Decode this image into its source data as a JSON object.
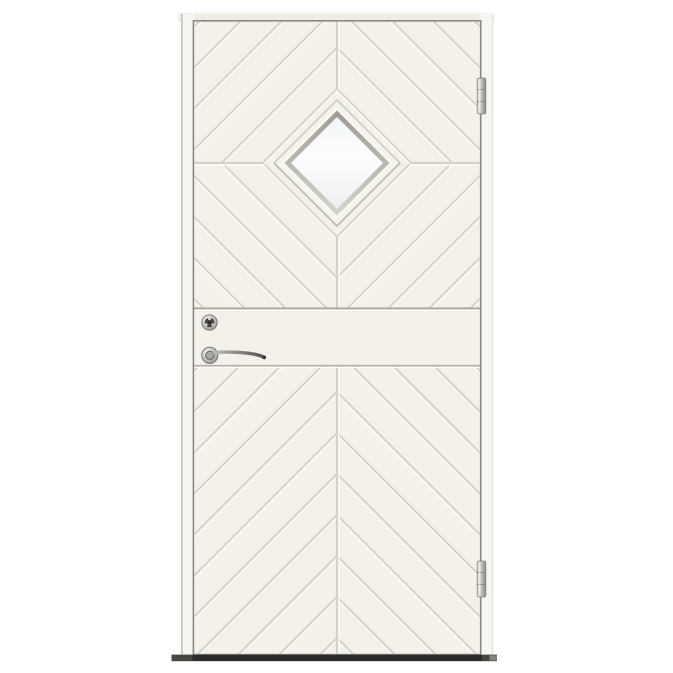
{
  "image": {
    "type": "product-photo",
    "subject": "White exterior door with diamond-shaped window, chevron groove panels, chrome lever handle, cylinder lock, two hinges and dark threshold",
    "background_color": "#ffffff"
  },
  "door": {
    "parts": {
      "window": "diamond-glazing",
      "hinge_count": 2,
      "handle_side": "left",
      "hardware_finish": "chrome",
      "pattern": "chevron-grooves-with-diamond-motif"
    },
    "palette": {
      "bg": "#ffffff",
      "face": "#f3f1ea",
      "groove": "#d4d1c8",
      "groove_hl": "#fcfbf7",
      "edge": "#8b8984",
      "rail_line": "#a6a39b",
      "rail_line_bottom": "#b3b0a8",
      "jamb": "#f6f5ef",
      "jamb_edge": "#c6c4be",
      "head": "#efede5",
      "frame_white": "#f5f3ed",
      "frame_edge": "#c7c4bb",
      "bevel_top": "#9f9b93",
      "bevel_bot": "#d6d3cb",
      "glass_top": "#f2f6f8",
      "glass_mid": "#fdfeff",
      "glass_bot": "#eceff1",
      "metal_hi": "#f0efec",
      "metal_mid": "#b9b8b5",
      "metal_dark": "#8e8c88",
      "lever_dark": "#555450",
      "threshold_outer": "#4a4742",
      "threshold": "#2d2b27"
    }
  }
}
